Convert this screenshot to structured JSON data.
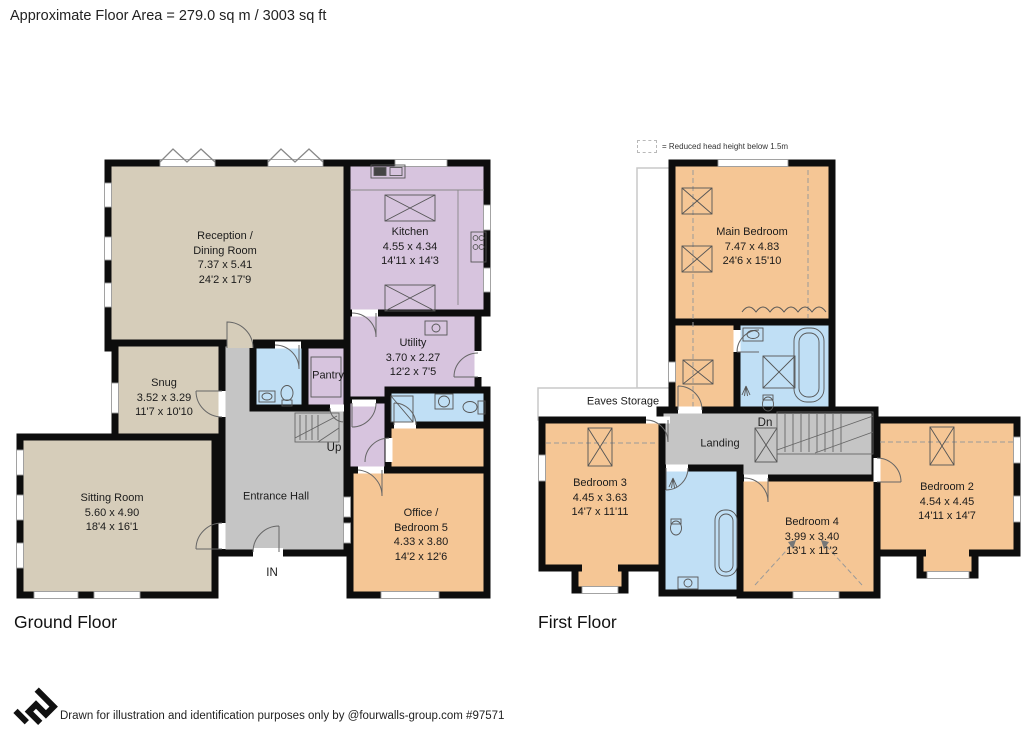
{
  "header": {
    "title": "Approximate Floor Area = 279.0 sq m / 3003 sq ft"
  },
  "colors": {
    "tan": "#d6cdba",
    "purple": "#d7c4de",
    "blue": "#c0dff5",
    "orange": "#f5c695",
    "gray": "#c5c5c5",
    "white": "#ffffff"
  },
  "ground": {
    "label": "Ground Floor",
    "labels": {
      "up": "Up",
      "in": "IN"
    },
    "rooms": {
      "reception": {
        "name": "Reception /\nDining Room",
        "metric": "7.37 x 5.41",
        "imperial": "24'2 x 17'9"
      },
      "kitchen": {
        "name": "Kitchen",
        "metric": "4.55 x 4.34",
        "imperial": "14'11 x 14'3"
      },
      "utility": {
        "name": "Utility",
        "metric": "3.70 x 2.27",
        "imperial": "12'2 x 7'5"
      },
      "pantry": {
        "name": "Pantry"
      },
      "snug": {
        "name": "Snug",
        "metric": "3.52 x 3.29",
        "imperial": "11'7 x 10'10"
      },
      "sitting": {
        "name": "Sitting Room",
        "metric": "5.60 x 4.90",
        "imperial": "18'4 x 16'1"
      },
      "hall": {
        "name": "Entrance Hall"
      },
      "office": {
        "name": "Office /\nBedroom 5",
        "metric": "4.33 x 3.80",
        "imperial": "14'2 x 12'6"
      }
    }
  },
  "first": {
    "label": "First Floor",
    "legend": "= Reduced head height below 1.5m",
    "labels": {
      "dn": "Dn"
    },
    "rooms": {
      "main": {
        "name": "Main Bedroom",
        "metric": "7.47 x 4.83",
        "imperial": "24'6 x 15'10"
      },
      "bedroom2": {
        "name": "Bedroom 2",
        "metric": "4.54 x 4.45",
        "imperial": "14'11 x 14'7"
      },
      "bedroom3": {
        "name": "Bedroom 3",
        "metric": "4.45 x 3.63",
        "imperial": "14'7 x 11'11"
      },
      "bedroom4": {
        "name": "Bedroom 4",
        "metric": "3.99 x 3.40",
        "imperial": "13'1 x 11'2"
      },
      "landing": {
        "name": "Landing"
      },
      "eaves": {
        "name": "Eaves Storage"
      }
    }
  },
  "footer": {
    "text": "Drawn for illustration and identification purposes only by @fourwalls-group.com #97571",
    "logo_icon": "fourwalls-logo"
  }
}
